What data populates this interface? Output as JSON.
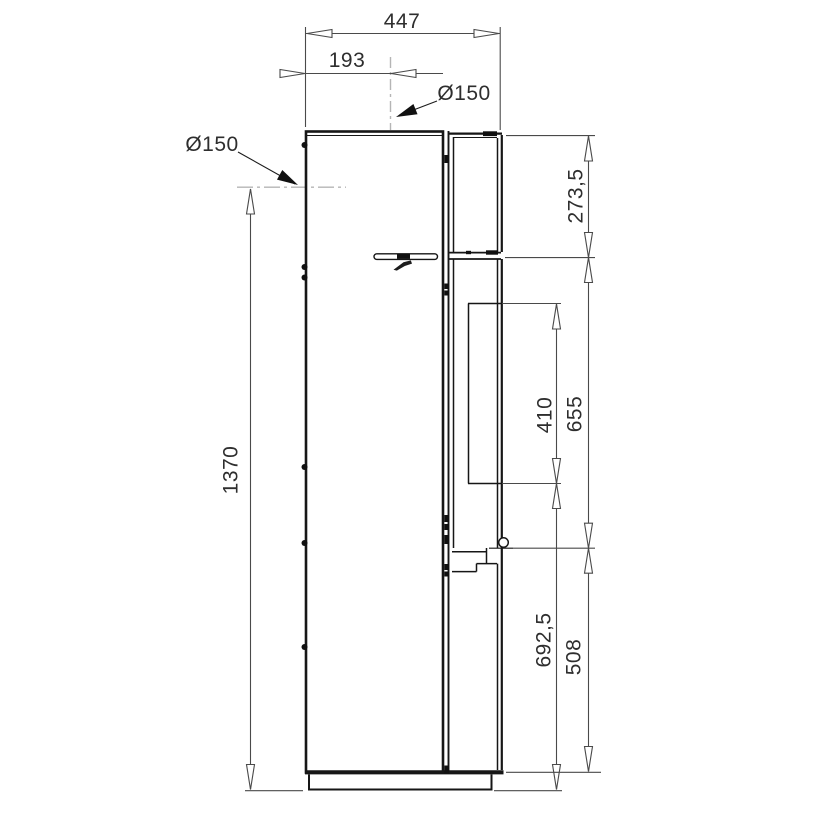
{
  "drawing": {
    "type": "technical-dimension-drawing",
    "subject": "stove-side-view",
    "units": "mm",
    "colors": {
      "background": "#ffffff",
      "outline": "#161616",
      "dimension_line": "#4a4a4a",
      "centerline": "#b5b5b5",
      "text": "#2e2e2e"
    },
    "labels": {
      "depth_total": "447",
      "top_flue_offset": "193",
      "top_flue_diameter": "Ø150",
      "rear_flue_diameter": "Ø150",
      "rear_flue_height": "1370",
      "upper_section_height": "273,5",
      "glass_height": "410",
      "door_section_height": "655",
      "lower_front_height": "692,5",
      "bottom_section_height": "508"
    }
  }
}
